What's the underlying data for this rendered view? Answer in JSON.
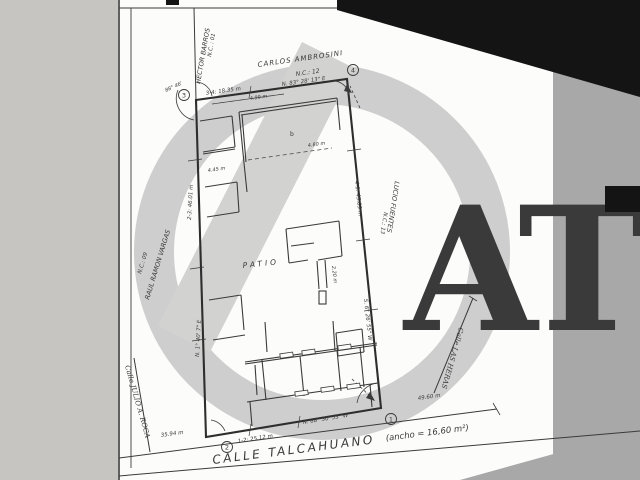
{
  "plan": {
    "streets": {
      "bottom_name": "CALLE TALCAHUANO",
      "bottom_width": "(ancho = 16,60 m²)",
      "right_name": "Calle LAS HERAS",
      "left_name": "Calle JULIO A. ROCA"
    },
    "neighbors": {
      "top": {
        "name": "CARLOS AMBROSINI",
        "nc": "N.C.: 12"
      },
      "top_left": {
        "name": "HECTOR BARROS",
        "nc": "N.C. : 01"
      },
      "left": {
        "name": "RAUL RAMON VARGAS",
        "nc": "N.C.: 09"
      },
      "right": {
        "name": "LUCIO FUENTES",
        "nc": "N.C.: 13"
      }
    },
    "boundary": {
      "top_dim": "3-4: 18.35 m",
      "top_bearing": "N. 83° 28' 13\" E",
      "bottom_dim": "1-2: 25.12 m",
      "bottom_bearing": "N. 88° 30' 53\" W",
      "left_dim": "2-3: 46.01 m",
      "left_bearing": "N. 1° 40' 7\" E",
      "right_dim": "4-1: 45.03 m",
      "right_bearing": "S. 6° 26' 55\" W",
      "corner_angle": "88° 46'"
    },
    "corners": {
      "c1": "1",
      "c2": "2",
      "c3": "3",
      "c4": "4"
    },
    "labels": {
      "patio": "PATIO",
      "room": "b"
    },
    "dims": {
      "street_left": "35.94 m",
      "street_right": "49.60 m",
      "top_room": "4.99 m",
      "left_room": "4.45 m",
      "interior": "4.80 m",
      "mid_room": "2.20 m"
    }
  },
  "watermark": {
    "text": "AT"
  },
  "colors": {
    "ink": "#3a3a3a",
    "paper": "#fcfcfa",
    "watermark": "#c9c9c9",
    "letters": "#bcbcbc",
    "scan_black": "#141414",
    "scan_gray": "#a8a8a8",
    "margin_gray": "#c6c5c2"
  }
}
